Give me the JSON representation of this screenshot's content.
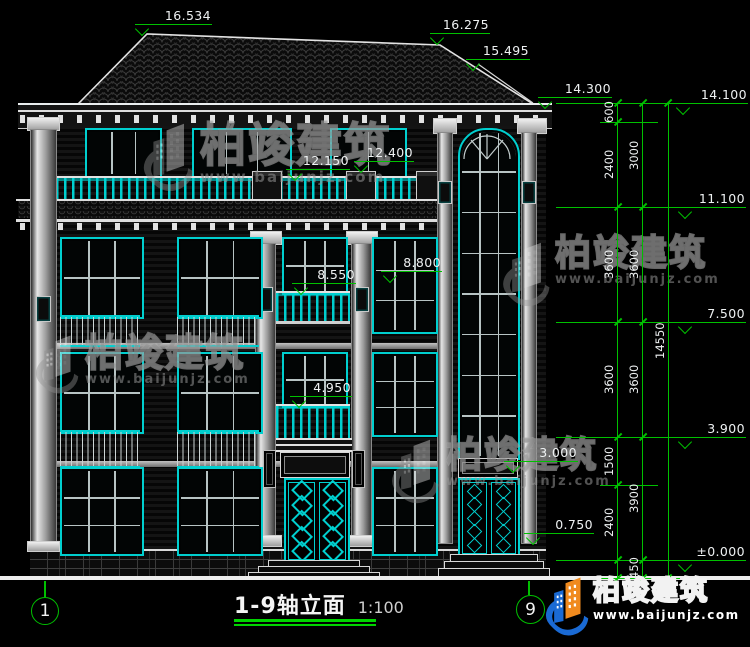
{
  "title": {
    "name": "1-9轴立面",
    "scale": "1:100"
  },
  "axes": {
    "left": "1",
    "right": "9"
  },
  "brand": {
    "name": "柏竣建筑",
    "url": "www.baijunjz.com"
  },
  "watermark": {
    "name": "柏竣建筑",
    "url": "www.baijunjz.com"
  },
  "colors": {
    "background": "#000000",
    "dimension_green": "#00c000",
    "window_cyan": "#00cfcf",
    "line_white": "#e9edee",
    "logo_blue": "#1a6ad4",
    "logo_orange": "#f08a1e"
  },
  "elevations": {
    "ridge_main": "16.534",
    "ridge_rear": "16.275",
    "tower_hip": "15.495",
    "eave_fascia": "14.300",
    "eave_top": "14.100",
    "attic_rail": "12.150",
    "attic_sill": "12.400",
    "level4": "11.100",
    "balcony3_rail": "8.550",
    "win3_sill": "8.800",
    "level3": "7.500",
    "balcony2_rail": "4.950",
    "level2": "3.900",
    "door_head": "3.000",
    "porch": "0.750",
    "level1": "±0.000"
  },
  "chains": {
    "inner": [
      "600",
      "2400",
      "3600",
      "3600",
      "1500",
      "2400"
    ],
    "middle": [
      "3000",
      "3600",
      "3600",
      "3900",
      "450"
    ],
    "outer": [
      "14550"
    ]
  }
}
